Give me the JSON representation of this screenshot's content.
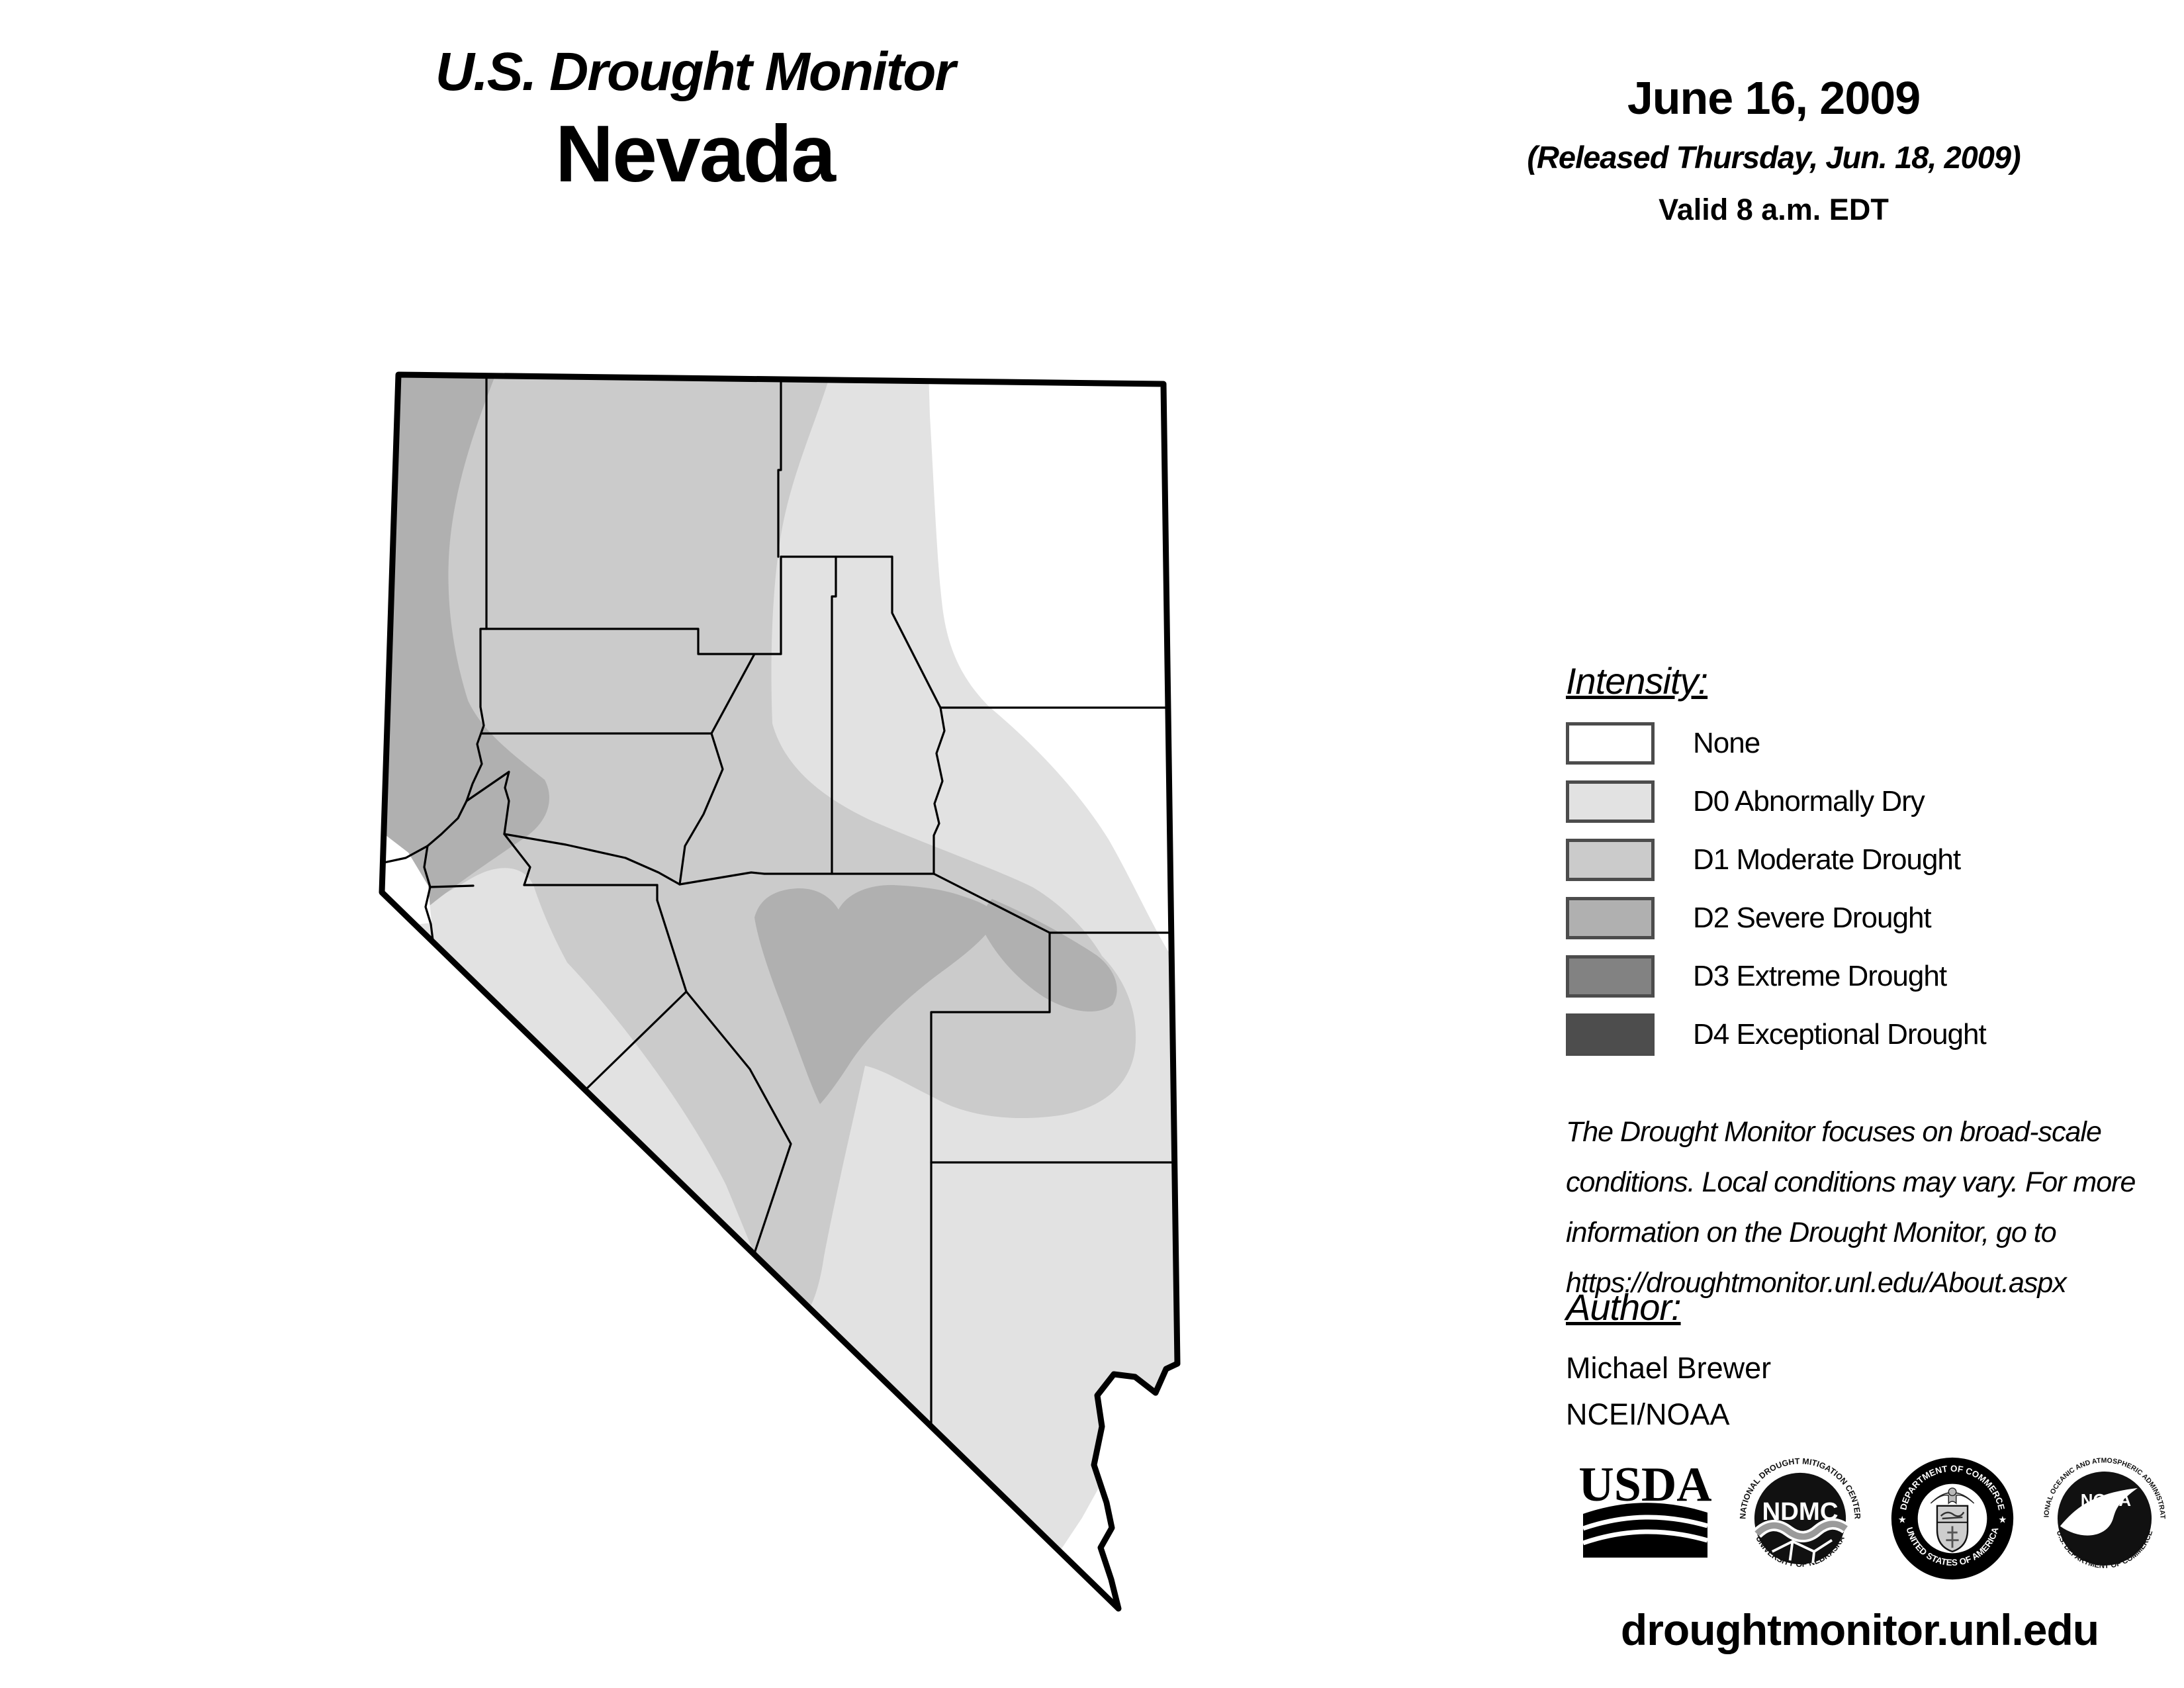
{
  "header": {
    "title": "U.S. Drought Monitor",
    "region": "Nevada"
  },
  "date_block": {
    "date": "June 16, 2009",
    "released": "(Released Thursday, Jun. 18, 2009)",
    "valid": "Valid 8 a.m. EDT"
  },
  "legend": {
    "heading": "Intensity:",
    "items": [
      {
        "label": "None",
        "color": "#ffffff"
      },
      {
        "label": "D0 Abnormally Dry",
        "color": "#e2e2e2"
      },
      {
        "label": "D1 Moderate Drought",
        "color": "#cbcbcb"
      },
      {
        "label": "D2 Severe Drought",
        "color": "#b0b0b0"
      },
      {
        "label": "D3 Extreme Drought",
        "color": "#828282"
      },
      {
        "label": "D4 Exceptional Drought",
        "color": "#4d4d4d"
      }
    ]
  },
  "map": {
    "palette": {
      "none": "#ffffff",
      "d0": "#e2e2e2",
      "d1": "#cbcbcb",
      "d2": "#b0b0b0"
    },
    "line_color": "#000000"
  },
  "disclaimer": {
    "line1": "The Drought Monitor focuses on broad-scale",
    "line2": "conditions. Local conditions may vary. For more",
    "line3": "information on the Drought Monitor, go to",
    "line4": "https://droughtmonitor.unl.edu/About.aspx"
  },
  "author_block": {
    "heading": "Author:",
    "name": "Michael Brewer",
    "org": "NCEI/NOAA"
  },
  "logos": {
    "usda": {
      "label": "USDA"
    },
    "ndmc": {
      "center": "NDMC",
      "ring_top": "NATIONAL DROUGHT MITIGATION CENTER",
      "ring_bottom": "UNIVERSITY OF NEBRASKA"
    },
    "doc": {
      "ring_top": "DEPARTMENT OF COMMERCE",
      "ring_bottom": "UNITED STATES OF AMERICA",
      "star_left": "★",
      "star_right": "★"
    },
    "noaa": {
      "center": "NOAA",
      "ring_top": "NATIONAL OCEANIC AND ATMOSPHERIC ADMINISTRATION",
      "ring_bottom": "U.S. DEPARTMENT OF COMMERCE"
    }
  },
  "footer": {
    "url": "droughtmonitor.unl.edu"
  }
}
